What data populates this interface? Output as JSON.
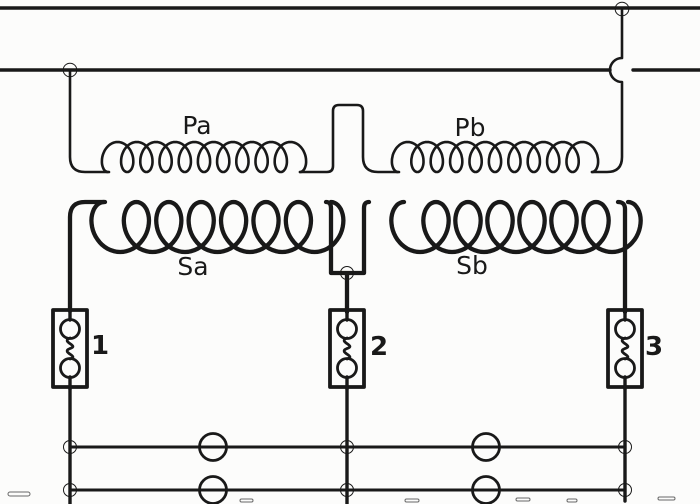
{
  "diagram": {
    "background_color": "#fcfcfb",
    "ink_color": "#191919",
    "labels": {
      "pa": "Pa",
      "pb": "Pb",
      "sa": "Sa",
      "sb": "Sb",
      "fuse_1": "1",
      "fuse_2": "2",
      "fuse_3": "3"
    },
    "schematic": {
      "supply_lines": 2,
      "primary_windings": [
        "Pa",
        "Pb"
      ],
      "secondary_windings": [
        "Sa",
        "Sb"
      ],
      "fuses": [
        "1",
        "2",
        "3"
      ],
      "lamps": 4
    }
  }
}
